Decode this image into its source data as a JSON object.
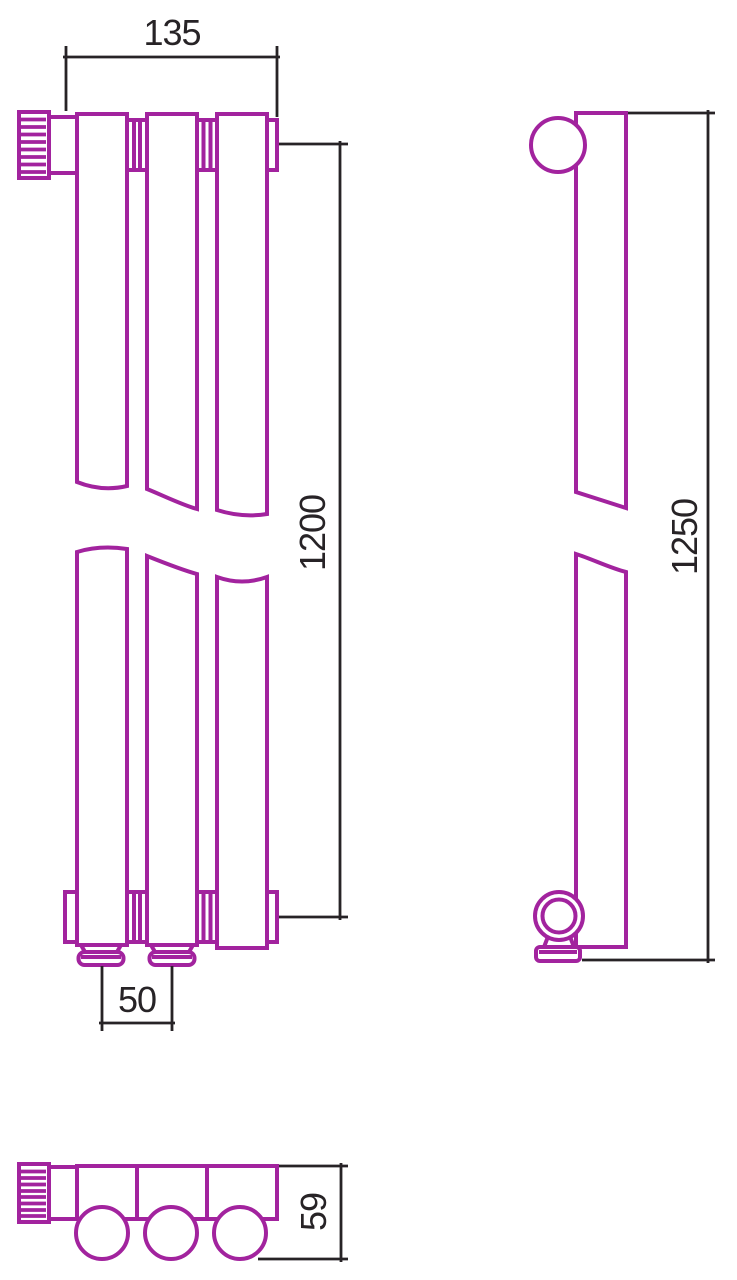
{
  "colors": {
    "product_line": "#A2239E",
    "dimension_line": "#272326",
    "background": "#FFFFFF"
  },
  "dimensions": {
    "width": "135",
    "front_height": "1200",
    "connection_pitch": "50",
    "side_height": "1250",
    "depth": "59"
  }
}
